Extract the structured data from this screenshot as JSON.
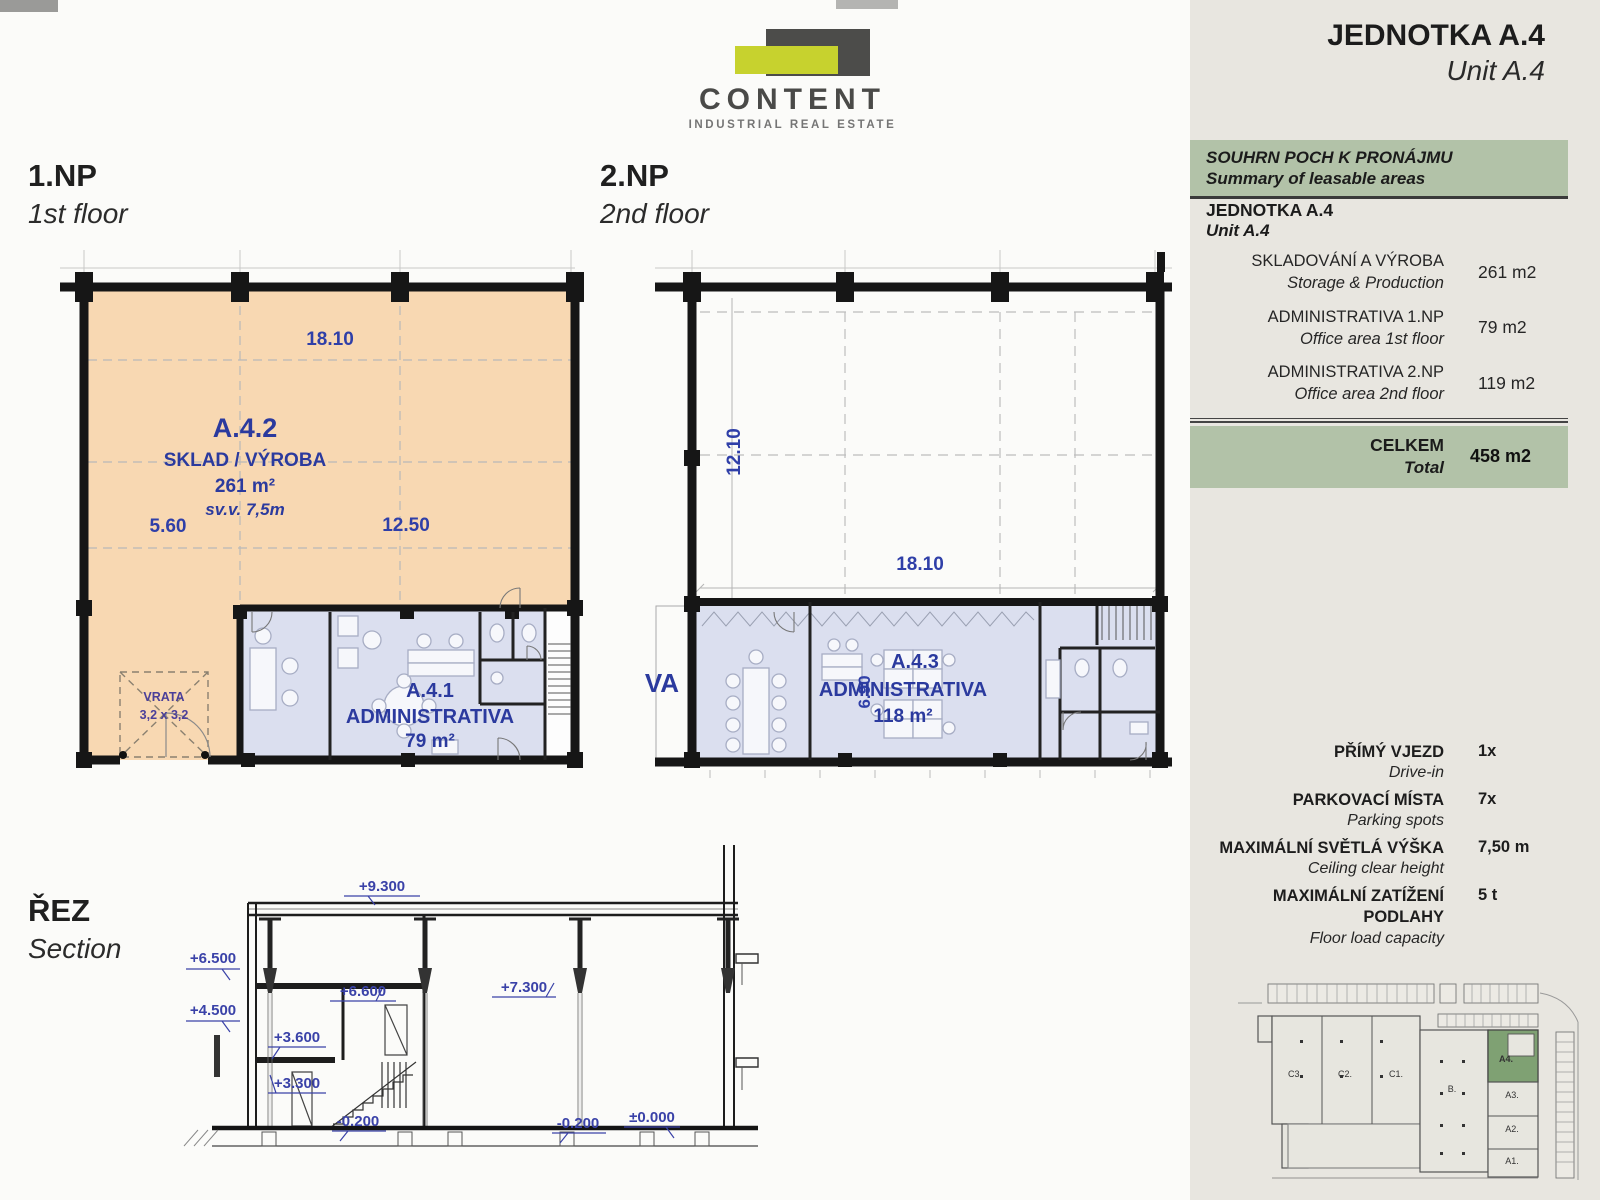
{
  "logo": {
    "name": "CONTENT",
    "tagline": "INDUSTRIAL REAL ESTATE"
  },
  "titles": {
    "floor1_cz": "1.NP",
    "floor1_en": "1st floor",
    "floor2_cz": "2.NP",
    "floor2_en": "2nd floor",
    "section_cz": "ŘEZ",
    "section_en": "Section"
  },
  "sidebar": {
    "unit_title_cz": "JEDNOTKA A.4",
    "unit_title_en": "Unit A.4",
    "summary_header_cz": "SOUHRN POCH K PRONÁJMU",
    "summary_header_en": "Summary of leasable areas",
    "unit_row_cz": "JEDNOTKA A.4",
    "unit_row_en": "Unit A.4",
    "rows": [
      {
        "cz": "SKLADOVÁNÍ A VÝROBA",
        "en": "Storage  & Production",
        "value": "261 m2"
      },
      {
        "cz": "ADMINISTRATIVA 1.NP",
        "en": "Office area 1st floor",
        "value": "79 m2"
      },
      {
        "cz": "ADMINISTRATIVA 2.NP",
        "en": "Office area 2nd floor",
        "value": "119 m2"
      }
    ],
    "total_cz": "CELKEM",
    "total_en": "Total",
    "total_value": "458 m2",
    "specs": [
      {
        "cz": "PŘÍMÝ VJEZD",
        "en": "Drive-in",
        "value": "1x"
      },
      {
        "cz": "PARKOVACÍ MÍSTA",
        "en": "Parking spots",
        "value": "7x"
      },
      {
        "cz": "MAXIMÁLNÍ SVĚTLÁ VÝŠKA",
        "en": "Ceiling clear height",
        "value": "7,50 m"
      },
      {
        "cz": "MAXIMÁLNÍ ZATÍŽENÍ PODLAHY",
        "en": "Floor load capacity",
        "value": "5 t"
      }
    ],
    "siteplan": {
      "c3": "C3.",
      "c2": "C2.",
      "c1": "C1.",
      "b": "B.",
      "a4": "A4.",
      "a3": "A3.",
      "a2": "A2.",
      "a1": "A1."
    }
  },
  "plan1": {
    "dim_top": "18.10",
    "dim_left": "5.60",
    "dim_right": "12.50",
    "hall_code": "A.4.2",
    "hall_name": "SKLAD / VÝROBA",
    "hall_area": "261 m²",
    "hall_height": "sv.v. 7,5m",
    "office_code": "A.4.1",
    "office_name": "ADMINISTRATIVA",
    "office_area": "79 m²",
    "gate_line1": "VRATA",
    "gate_line2": "3,2 x 3,2"
  },
  "plan2": {
    "dim_left": "12.10",
    "dim_top": "18.10",
    "dim_depth": "6.90",
    "office_code": "A.4.3",
    "office_name": "ADMINISTRATIVA",
    "office_area": "118 m²",
    "partial_label": "VA"
  },
  "section": {
    "levels": {
      "l9300": "+9.300",
      "l6500": "+6.500",
      "l4500": "+4.500",
      "l6600": "+6.600",
      "l7300": "+7.300",
      "l3600": "+3.600",
      "l3300": "+3.300",
      "lm0200a": "-0.200",
      "lm0200b": "-0.200",
      "l0000": "±0.000"
    }
  },
  "colors": {
    "sidebar_bg": "#e8e6e0",
    "accent_green": "#b2c2a8",
    "hall_fill": "#f8d8b2",
    "office_fill": "#dbdfef",
    "label_blue": "#2b3a9e",
    "logo_yellow": "#c7d22e",
    "logo_dark": "#4c4c4a",
    "site_highlight": "#7fa173",
    "wall_black": "#161616"
  }
}
